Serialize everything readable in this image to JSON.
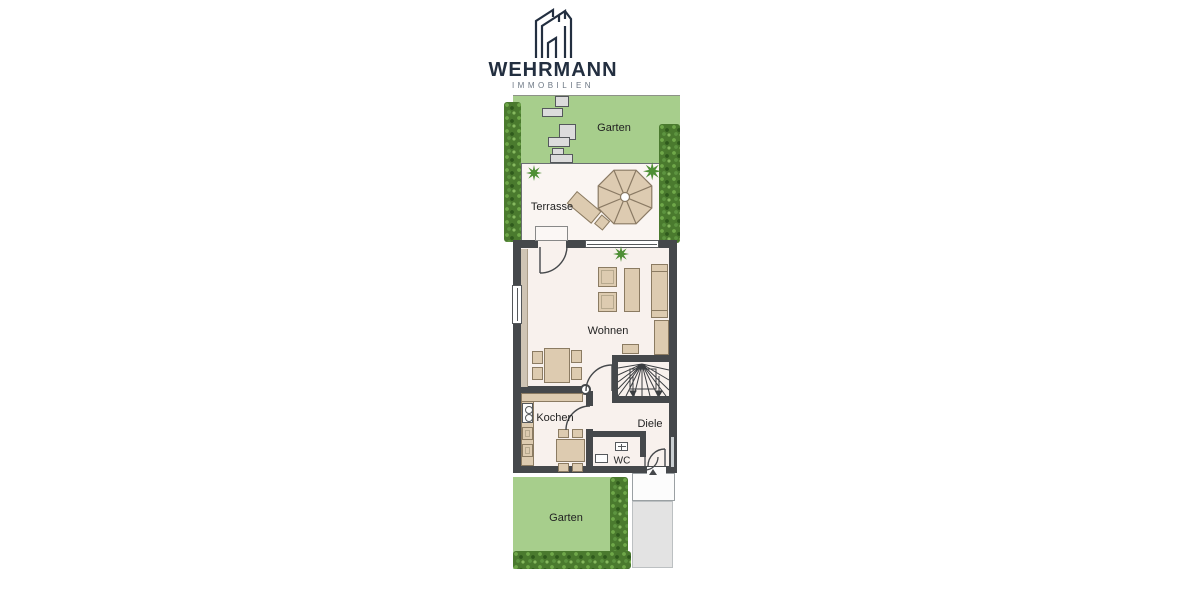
{
  "logo": {
    "brand": "WEHRMANN",
    "tagline": "IMMOBILIEN"
  },
  "floorplan": {
    "rooms": {
      "garden_top": "Garten",
      "terrace": "Terrasse",
      "living": "Wohnen",
      "kitchen": "Kochen",
      "hall": "Diele",
      "wc": "WC",
      "garden_bottom": "Garten"
    },
    "colors": {
      "garden": "#a7ce8c",
      "hedge": "#4a7a2e",
      "wall": "#45484b",
      "floor": "#f8f1ed",
      "furniture": "#ddcbb0",
      "furniture_border": "#8b7b62",
      "paving": "#e3e3e3",
      "logo_navy": "#232f40",
      "tagline_gray": "#6b7683"
    }
  }
}
